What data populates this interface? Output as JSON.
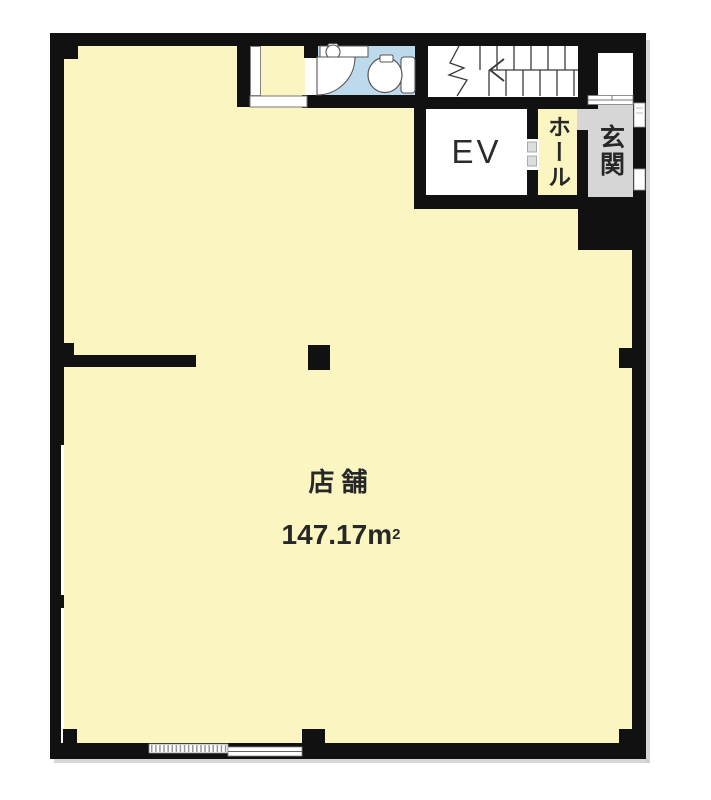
{
  "floorplan": {
    "labels": {
      "shop": "店舗",
      "area_value": "147.17",
      "area_unit_base": "m",
      "area_unit_exponent": "2",
      "elevator": "EV",
      "hall": "ホール",
      "entrance": "玄関"
    },
    "colors": {
      "floor": "#FAF5C1",
      "toilet_floor": "#BCDAEC",
      "entrance_floor": "#D6D6D6",
      "wall": "#111111",
      "background": "#FFFFFF"
    }
  }
}
